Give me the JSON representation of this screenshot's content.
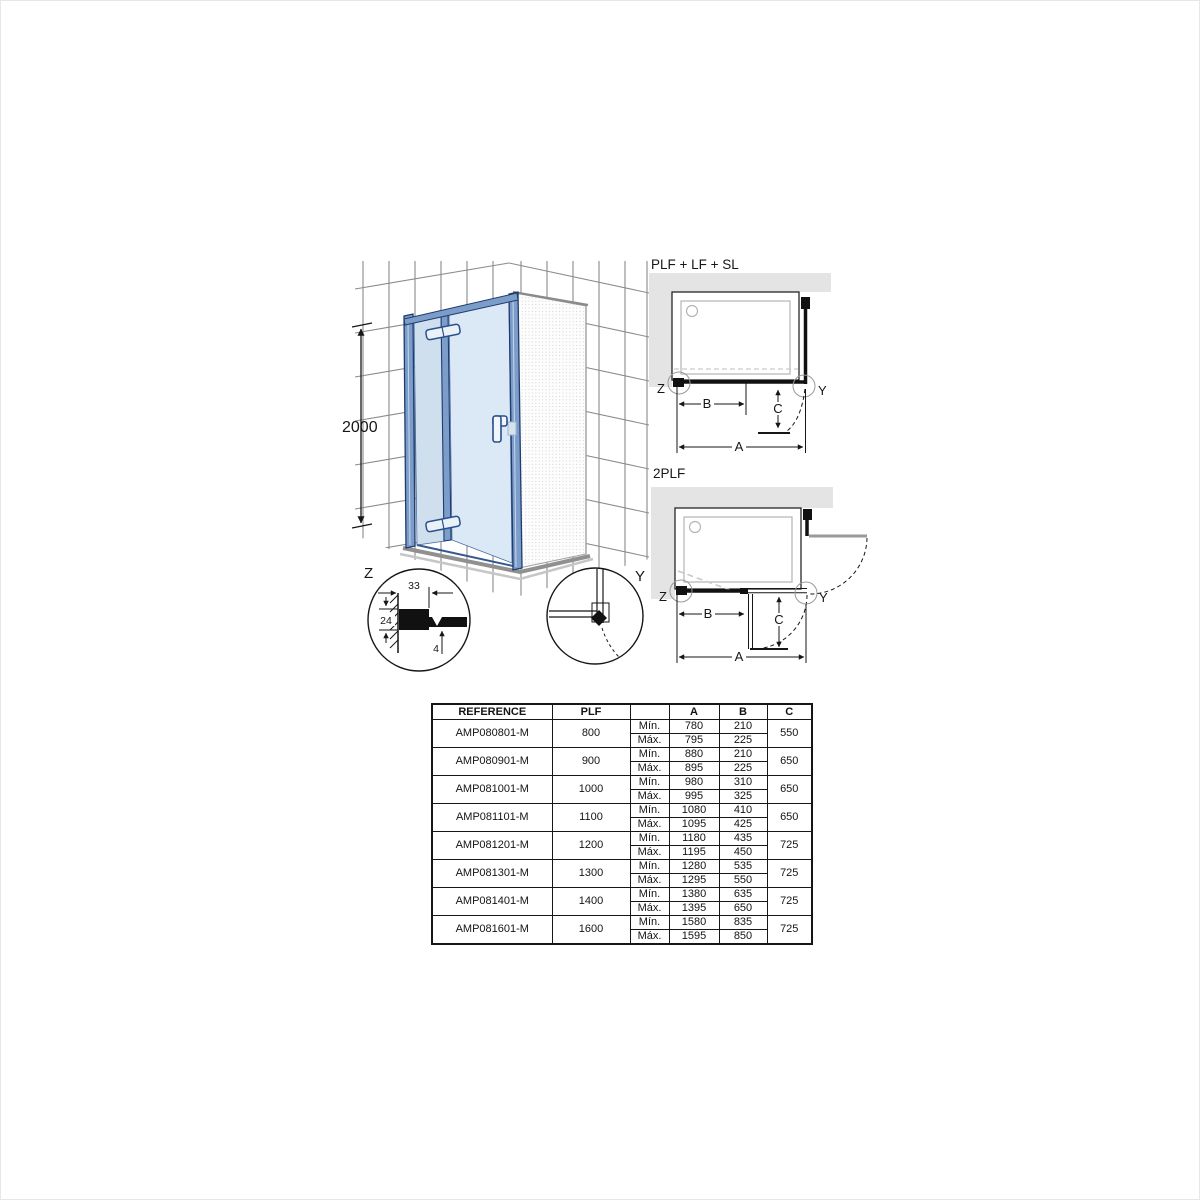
{
  "colors": {
    "glass_light": "#dbe8f5",
    "glass_mid": "#cfdfee",
    "frame_blue": "#7c9dca",
    "frame_dark": "#1e3c6e",
    "wall_band_gray": "#e4e4e4",
    "tile_line_gray": "#8a8a8a",
    "tray_gray": "#909090",
    "dash_gray": "#c9c9c9",
    "line_black": "#161616"
  },
  "isometric": {
    "height_label": "2000",
    "detail_z": {
      "label": "Z",
      "dim_width": "33",
      "dim_height": "24",
      "dim_glass": "4"
    },
    "detail_y": {
      "label": "Y"
    }
  },
  "diagram_top": {
    "title": "PLF + LF + SL",
    "label_z": "Z",
    "label_y": "Y",
    "label_a": "A",
    "label_b": "B",
    "label_c": "C"
  },
  "diagram_bottom": {
    "title": "2PLF",
    "label_z": "Z",
    "label_y": "Y",
    "label_a": "A",
    "label_b": "B",
    "label_c": "C"
  },
  "table": {
    "headers": {
      "reference": "REFERENCE",
      "plf": "PLF",
      "minmax": "",
      "a": "A",
      "b": "B",
      "c": "C"
    },
    "min_label": "Mín.",
    "max_label": "Máx.",
    "rows": [
      {
        "reference": "AMP080801-M",
        "plf": "800",
        "a_min": "780",
        "a_max": "795",
        "b_min": "210",
        "b_max": "225",
        "c": "550"
      },
      {
        "reference": "AMP080901-M",
        "plf": "900",
        "a_min": "880",
        "a_max": "895",
        "b_min": "210",
        "b_max": "225",
        "c": "650"
      },
      {
        "reference": "AMP081001-M",
        "plf": "1000",
        "a_min": "980",
        "a_max": "995",
        "b_min": "310",
        "b_max": "325",
        "c": "650"
      },
      {
        "reference": "AMP081101-M",
        "plf": "1100",
        "a_min": "1080",
        "a_max": "1095",
        "b_min": "410",
        "b_max": "425",
        "c": "650"
      },
      {
        "reference": "AMP081201-M",
        "plf": "1200",
        "a_min": "1180",
        "a_max": "1195",
        "b_min": "435",
        "b_max": "450",
        "c": "725"
      },
      {
        "reference": "AMP081301-M",
        "plf": "1300",
        "a_min": "1280",
        "a_max": "1295",
        "b_min": "535",
        "b_max": "550",
        "c": "725"
      },
      {
        "reference": "AMP081401-M",
        "plf": "1400",
        "a_min": "1380",
        "a_max": "1395",
        "b_min": "635",
        "b_max": "650",
        "c": "725"
      },
      {
        "reference": "AMP081601-M",
        "plf": "1600",
        "a_min": "1580",
        "a_max": "1595",
        "b_min": "835",
        "b_max": "850",
        "c": "725"
      }
    ]
  }
}
